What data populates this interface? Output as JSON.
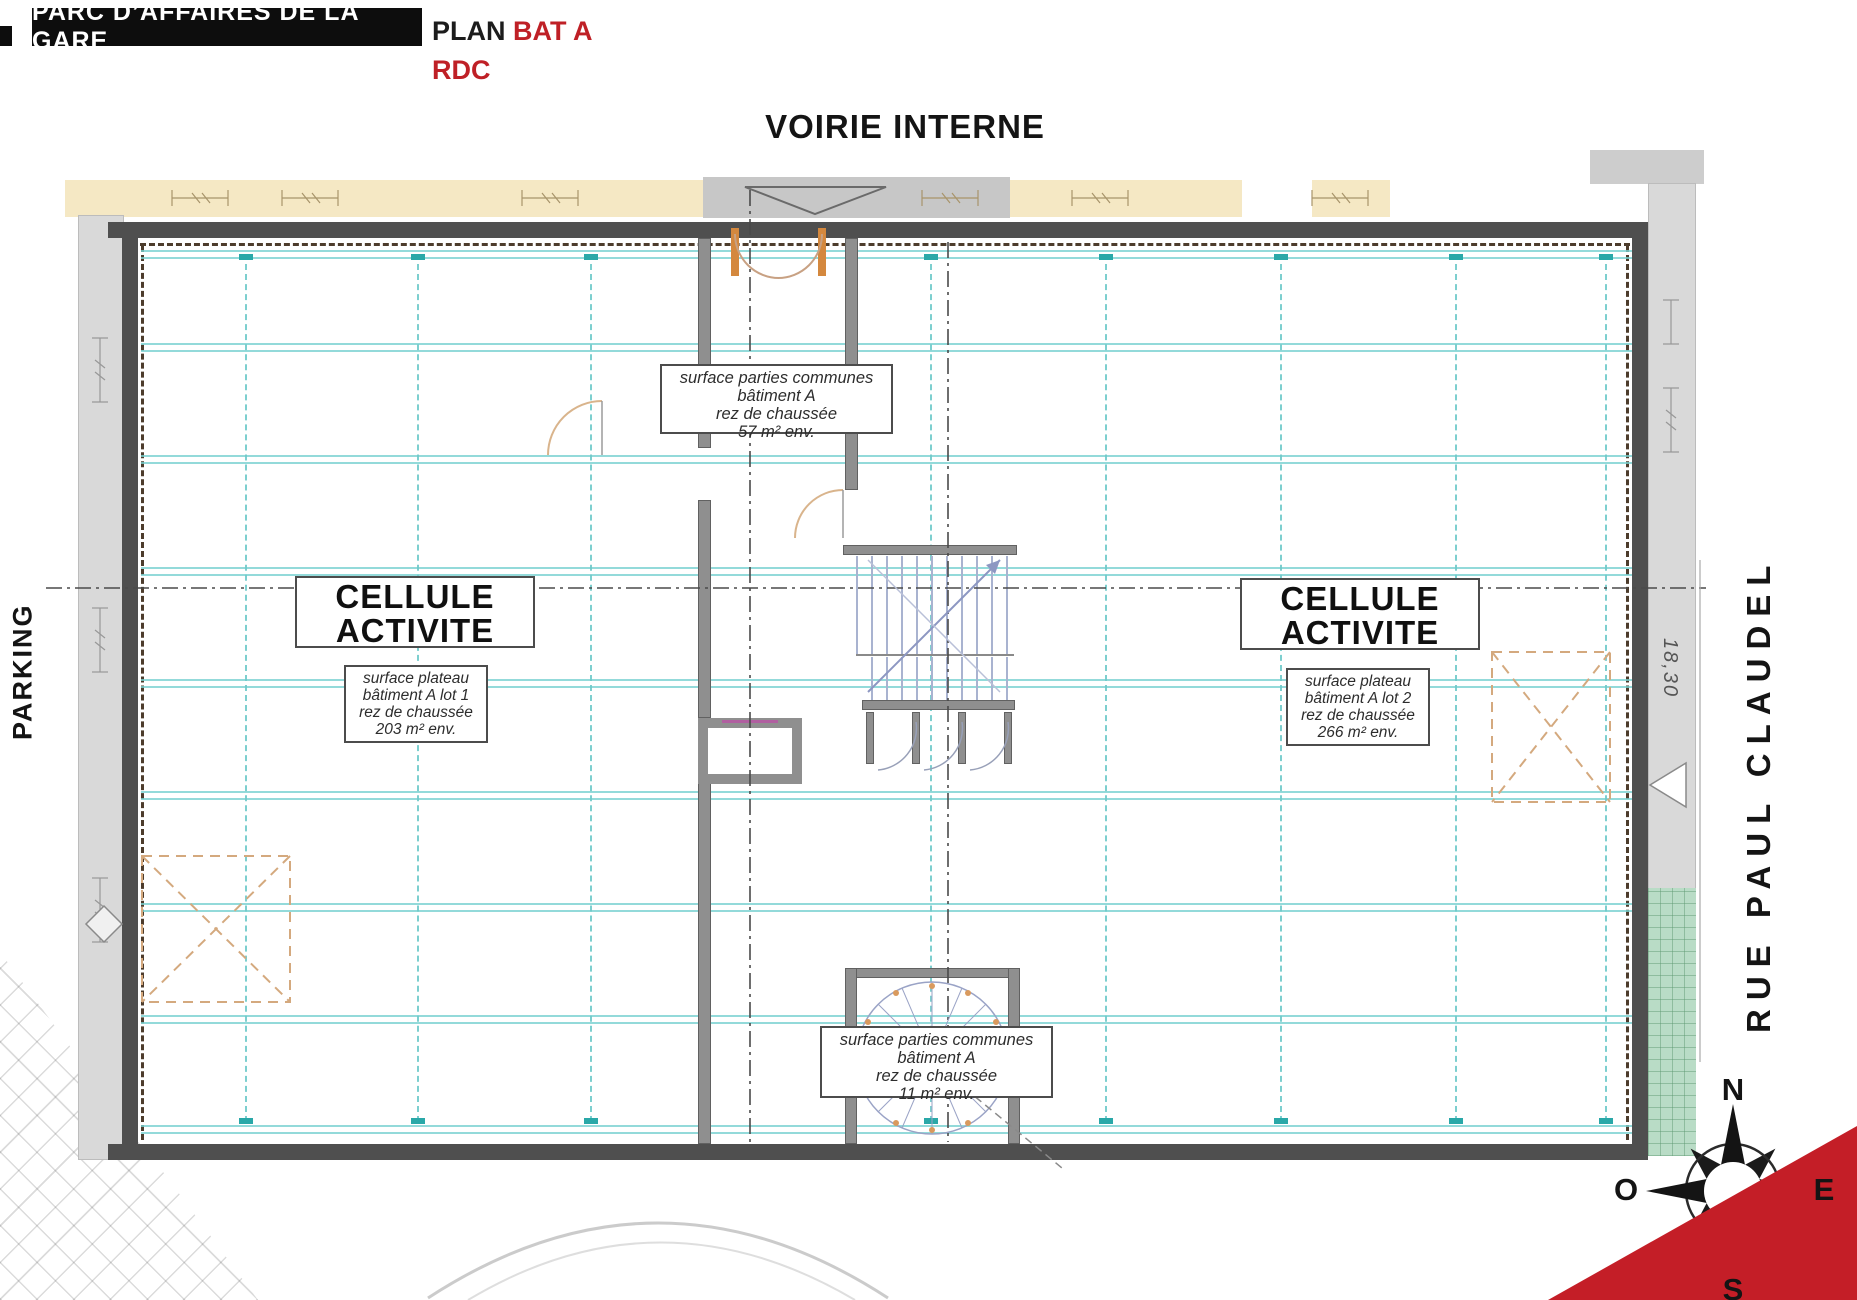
{
  "header": {
    "project": "PARC D’AFFAIRES DE LA GARE",
    "plan_prefix": "PLAN",
    "plan_building": "BAT A",
    "level": "RDC"
  },
  "streets": {
    "top": "VOIRIE INTERNE",
    "left": "PARKING",
    "right": "RUE PAUL CLAUDEL"
  },
  "zones": {
    "cell_left": {
      "line1": "CELLULE",
      "line2": "ACTIVITE"
    },
    "cell_right": {
      "line1": "CELLULE",
      "line2": "ACTIVITE"
    }
  },
  "boxes": {
    "common_top": {
      "lines": [
        "surface parties communes",
        "bâtiment A",
        "rez de chaussée",
        "57 m² env."
      ]
    },
    "common_bottom": {
      "lines": [
        "surface parties communes",
        "bâtiment A",
        "rez de chaussée",
        "11 m² env."
      ]
    },
    "plateau_left": {
      "lines": [
        "surface plateau",
        "bâtiment A lot 1",
        "rez de chaussée",
        "203 m² env."
      ]
    },
    "plateau_right": {
      "lines": [
        "surface plateau",
        "bâtiment A lot 2",
        "rez de chaussée",
        "266 m² env."
      ]
    }
  },
  "dimensions": {
    "street_width": "18,30"
  },
  "compass": {
    "n": "N",
    "s": "S",
    "e": "E",
    "o": "O"
  },
  "colors": {
    "accent_red": "#c01f26",
    "wall_dark": "#4f4f4f",
    "beam_teal": "#6fcaca",
    "cream_band": "#f5e8c4",
    "green_strip": "#b9dcc6",
    "tan_dashed": "#d4a97e"
  }
}
